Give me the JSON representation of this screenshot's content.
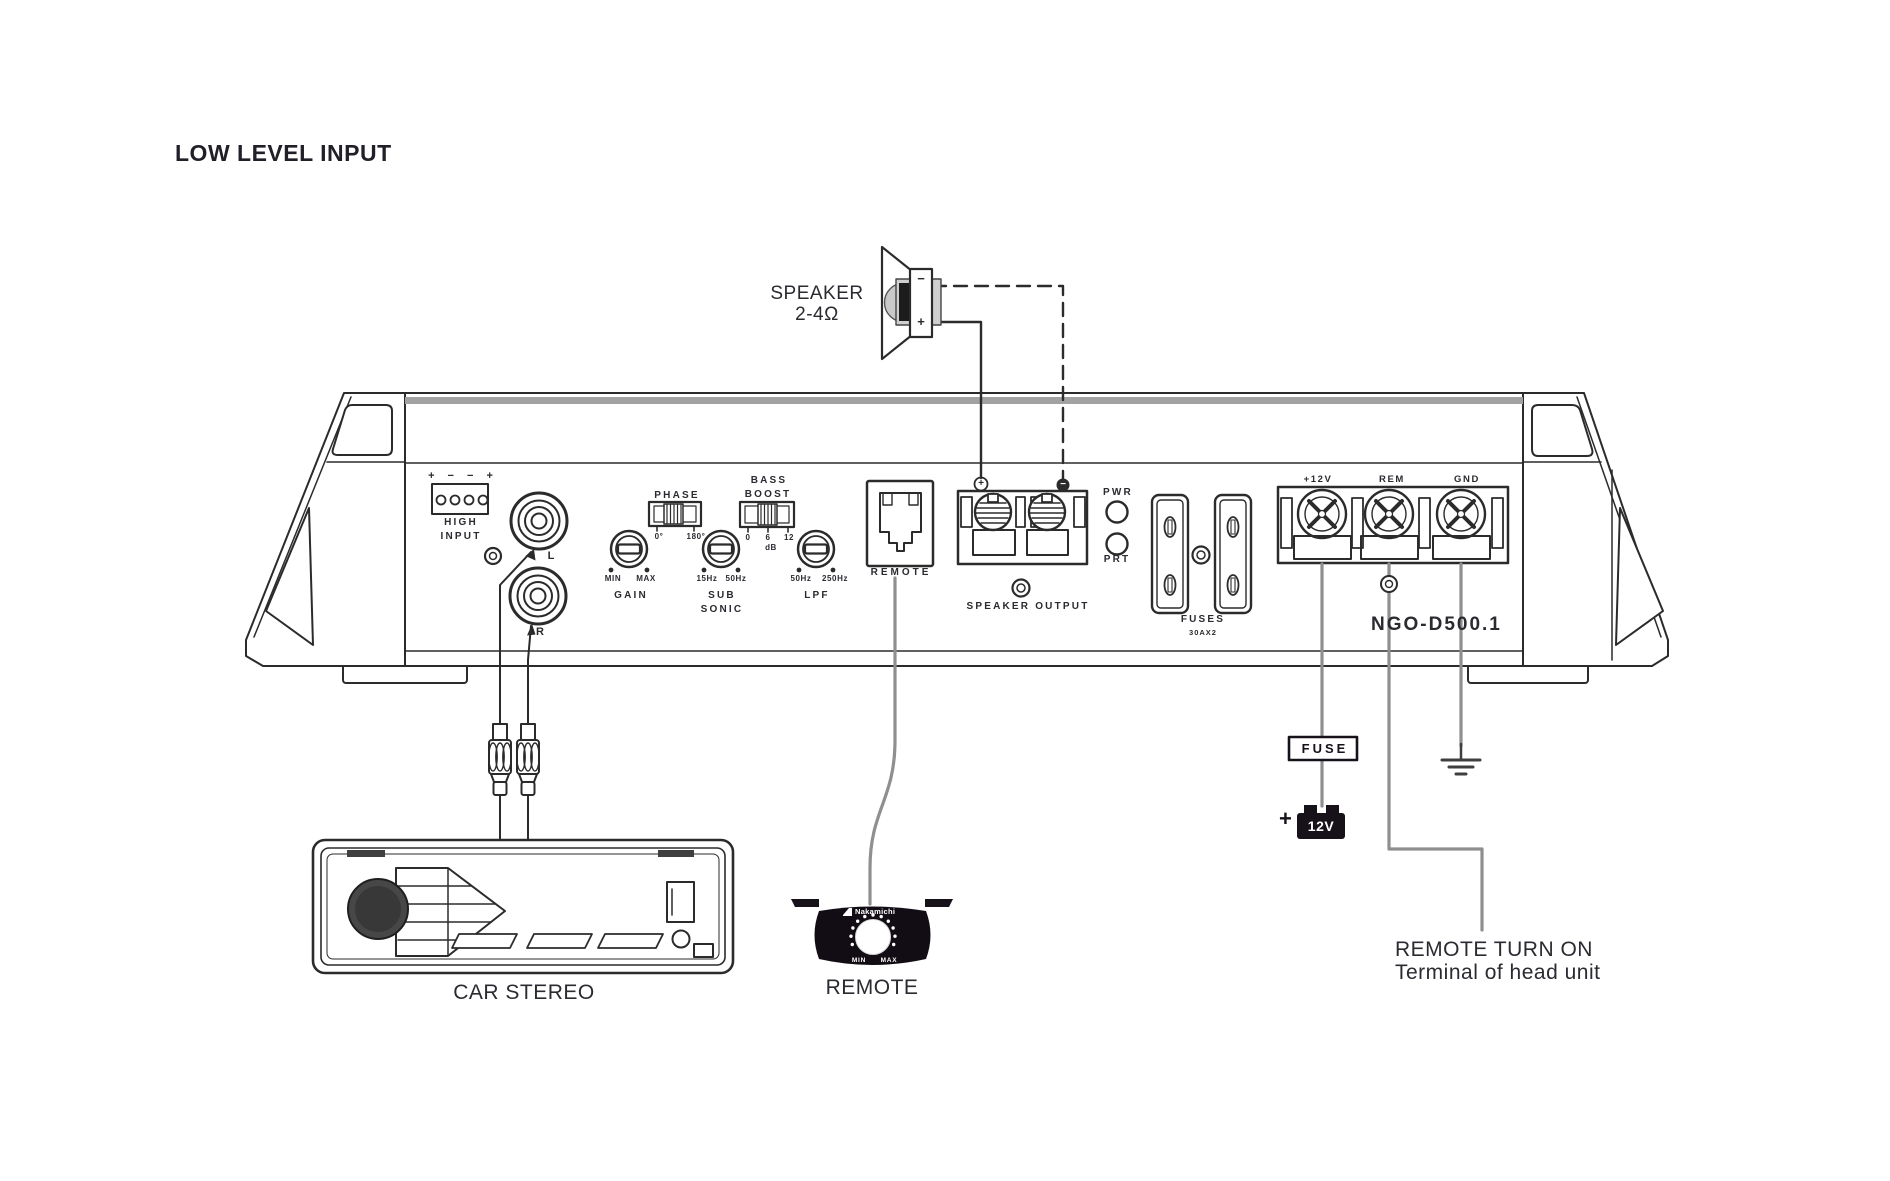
{
  "title": "LOW LEVEL INPUT",
  "colors": {
    "line": "#2b2b2b",
    "wire": "#8f8f8f",
    "dark": "#17121a",
    "top_band": "#a2a2a2"
  },
  "speaker": {
    "name_line1": "SPEAKER",
    "name_line2": "2-4Ω",
    "minus": "−",
    "plus": "+"
  },
  "amplifier": {
    "model": "NGO-D500.1",
    "high_input": {
      "polarity": "+ − − +",
      "label_line1": "HIGH",
      "label_line2": "INPUT"
    },
    "rca": {
      "left": "L",
      "right": "R"
    },
    "phase": {
      "label": "PHASE",
      "left_tick": "0°",
      "right_tick": "180°"
    },
    "gain": {
      "label": "GAIN",
      "min": "MIN",
      "max": "MAX"
    },
    "bass_boost": {
      "label_line1": "BASS",
      "label_line2": "BOOST",
      "ticks": [
        "0",
        "6",
        "12"
      ],
      "unit": "dB"
    },
    "sub_sonic": {
      "label_line1": "SUB",
      "label_line2": "SONIC",
      "min": "15Hz",
      "max": "50Hz"
    },
    "lpf": {
      "label": "LPF",
      "min": "50Hz",
      "max": "250Hz"
    },
    "remote_jack_label": "REMOTE",
    "speaker_output": {
      "label": "SPEAKER OUTPUT",
      "plus": "+",
      "minus": "−"
    },
    "leds": {
      "power": "PWR",
      "protect": "PRT"
    },
    "fuses": {
      "label": "FUSES",
      "rating": "30AX2"
    },
    "power_terminals": {
      "plus12v": "+12V",
      "rem": "REM",
      "gnd": "GND"
    }
  },
  "car_stereo_label": "CAR STEREO",
  "remote_control": {
    "brand": "Nakamichi",
    "min": "MIN",
    "max": "MAX",
    "label": "REMOTE"
  },
  "power_chain": {
    "fuse": "FUSE",
    "battery_plus": "+",
    "battery": "12V"
  },
  "note": {
    "line1": "REMOTE TURN ON",
    "line2": "Terminal of head unit"
  }
}
